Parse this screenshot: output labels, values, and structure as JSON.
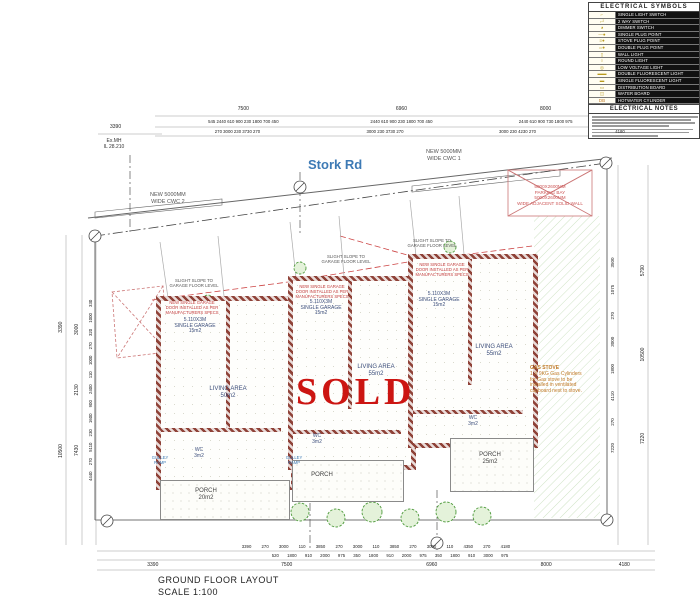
{
  "colors": {
    "wall_hatch": "#97493f",
    "sold_red": "#cc1512",
    "road_blue": "#3d7ab5",
    "plant_green": "#4e9a3c",
    "gas_orange": "#c07a28",
    "room_navy": "#3d4f7c",
    "parking_red": "#cc5555"
  },
  "legend": {
    "title": "ELECTRICAL  SYMBOLS",
    "rows": [
      {
        "glyph": "⌐",
        "label": "SINGLE LIGHT SWITCH"
      },
      {
        "glyph": "⌐²",
        "label": "2 WAY SWITCH"
      },
      {
        "glyph": "◕",
        "label": "DIMMER SWITCH"
      },
      {
        "glyph": "—●",
        "label": "SINGLE PLUG POINT"
      },
      {
        "glyph": "≡●",
        "label": "STOVE PLUG POINT"
      },
      {
        "glyph": "═●",
        "label": "DOUBLE PLUG POINT"
      },
      {
        "glyph": "▯",
        "label": "WALL LIGHT"
      },
      {
        "glyph": "○",
        "label": "ROUND LIGHT"
      },
      {
        "glyph": "◎",
        "label": "LOW VOLTAGE LIGHT"
      },
      {
        "glyph": "▬▬",
        "label": "DOUBLE FLUORESCENT LIGHT"
      },
      {
        "glyph": "▬",
        "label": "SINGLE FLUORESCENT LIGHT"
      },
      {
        "glyph": "▭",
        "label": "DISTRIBUTION BOARD"
      },
      {
        "glyph": "◫",
        "label": "WATER BOARD"
      },
      {
        "glyph": "DB",
        "label": "HOTWATER CYLINDER"
      }
    ],
    "notes_title": "ELECTRICAL  NOTES"
  },
  "road": {
    "name": "Stork Rd",
    "cwc2": "NEW 5000MM\nWIDE CWC 2",
    "cwc1": "NEW 5000MM\nWIDE CWC 1"
  },
  "survey": {
    "manhole": "Ex.MH\nIL 28.210"
  },
  "parking": {
    "line1": "5000X2600MM",
    "line2": "PARKING BAY",
    "line3": "5000X2600MM",
    "line4": "WIDE ADJACENT SOLID WALL"
  },
  "notes": {
    "slope": "SLIGHT SLOPE TO\nGARAGE FLOOR LEVEL",
    "garage_door": "NEW SINGLE GARAGE\nDOOR INSTALLED AS PER\nMANUFACTURERS SPECS",
    "gulley": "GULLEY\nRAMP"
  },
  "units": {
    "u1": {
      "garage": "5.110X3M\nSINGLE GARAGE\n15m2",
      "living": "LIVING AREA\n50m2",
      "wc": "WC\n3m2",
      "porch": "PORCH\n20m2"
    },
    "u2": {
      "garage": "5.110X3M\nSINGLE GARAGE\n15m2",
      "living": "LIVING AREA\n55m2",
      "wc": "WC\n3m2",
      "porch": "PORCH"
    },
    "u3": {
      "garage": "5.110X3M\nSINGLE GARAGE\n15m2",
      "living": "LIVING AREA\n55m2",
      "wc": "WC\n3m2",
      "porch": "PORCH\n25m2"
    }
  },
  "sold_stamp": "SOLD",
  "gas_note": {
    "title": "GAS STOVE",
    "body": "1 X 9KG Gas Cylinders for Gas stove to be installed in ventilated cupboard next to stove."
  },
  "dims": {
    "top_overall": [
      "7500",
      "6960",
      "8000"
    ],
    "top_sub1": [
      "545 2440 610 900 230 1800 700 450",
      "2440 610 900 230 1800 700 450",
      "2440 610 900 730 1800 975"
    ],
    "top_sub2": [
      "270 3000 230 3730 270",
      "3000 230 3730 270",
      "3000 230 4230 270",
      "4180"
    ],
    "top_left": "3390",
    "left_outer": "10500 3390",
    "left_mid": "7430 2130 3000",
    "left_inner": "4440 270 5110 230 1600 900 2400 110 1000 270 320 1000 330",
    "right_inner": "7220 270 4110 1800 3000 270 1075 3500",
    "right_outer": "7220 10500 5790",
    "bottom_sub1": "3390 270 3000 110 3850 270 3000 110 3850 270 3000 110 4350 270 4180",
    "bottom_sub2": "520 1800 910 2000 975 350 1800 910 2000 975 350 1800 910 3000 975",
    "bottom_overall": [
      "3390",
      "7500",
      "6960",
      "8000",
      "4180"
    ]
  },
  "title_block": {
    "title": "GROUND FLOOR LAYOUT",
    "scale": "SCALE 1:100"
  }
}
